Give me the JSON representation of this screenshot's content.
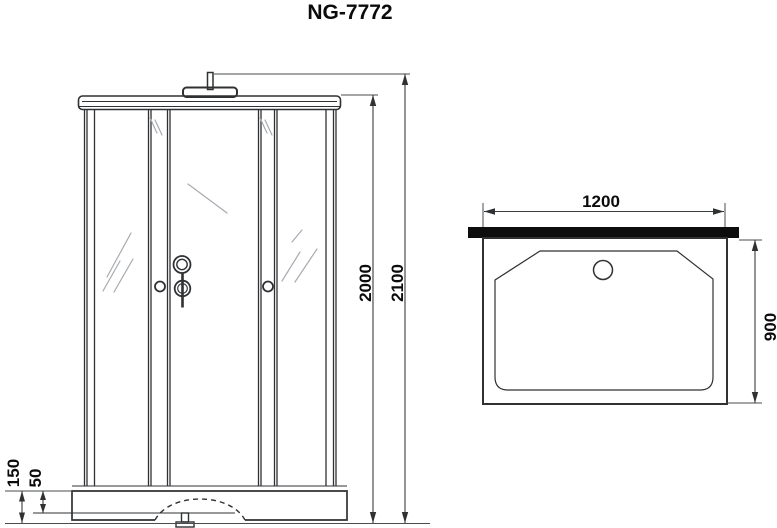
{
  "title": "NG-7772",
  "front_view": {
    "dimensions": {
      "total_height": "2100",
      "cabin_height": "2000",
      "tray_height": "150",
      "base_height": "50"
    }
  },
  "top_view": {
    "dimensions": {
      "width": "1200",
      "depth": "900"
    },
    "features": {
      "back_wall": "solid-black-bar",
      "drain": "circle"
    }
  },
  "colors": {
    "line": "#2f3133",
    "glass_hatch": "#a7abb0",
    "back_wall_bar": "#0d0d0d",
    "background": "#ffffff",
    "text": "#0b0b0b"
  }
}
